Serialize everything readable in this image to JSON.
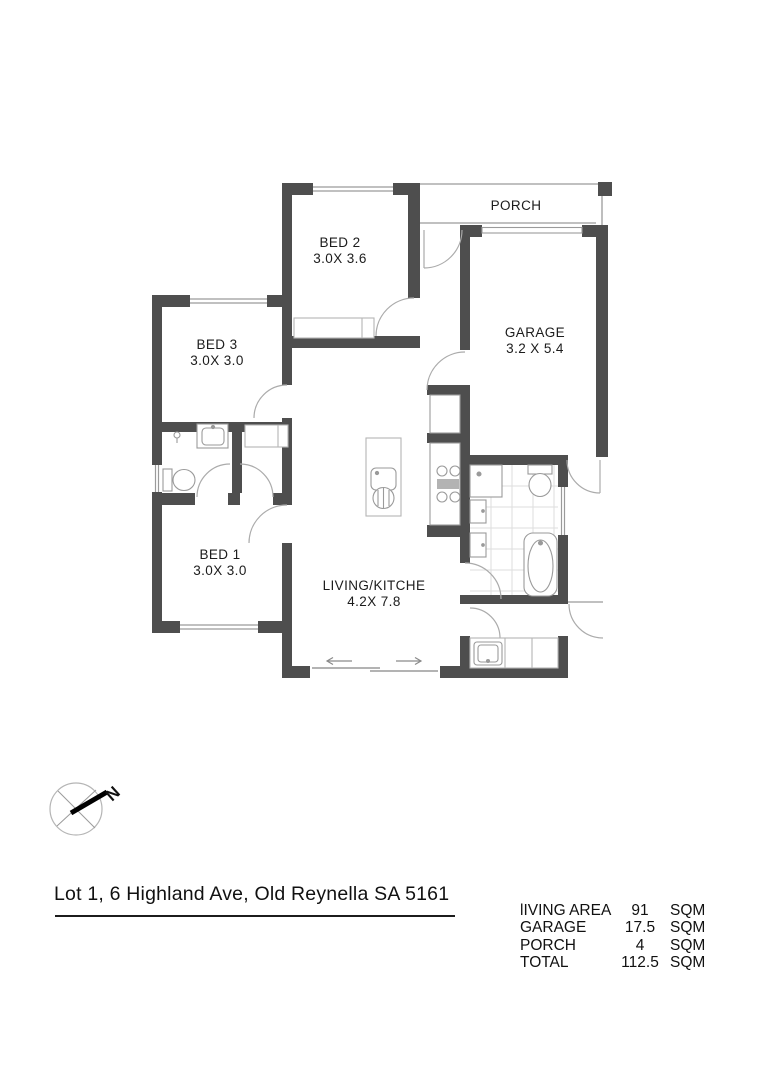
{
  "plan": {
    "rooms": [
      {
        "name": "BED 2",
        "dims": "3.0X 3.6"
      },
      {
        "name": "BED 3",
        "dims": "3.0X 3.0"
      },
      {
        "name": "BED 1",
        "dims": "3.0X 3.0"
      },
      {
        "name": "GARAGE",
        "dims": "3.2 X 5.4"
      },
      {
        "name": "LIVING/KITCHE",
        "dims": "4.2X 7.8"
      },
      {
        "name": "PORCH",
        "dims": ""
      }
    ],
    "compass_label": "N"
  },
  "footer": {
    "address": "Lot 1, 6 Highland Ave, Old Reynella SA 5161",
    "areas": {
      "rows": [
        {
          "label": "lIVING AREA",
          "value": "91",
          "unit": "SQM"
        },
        {
          "label": "GARAGE",
          "value": "17.5",
          "unit": "SQM"
        },
        {
          "label": "PORCH",
          "value": "4",
          "unit": "SQM"
        },
        {
          "label": "TOTAL",
          "value": "112.5",
          "unit": "SQM"
        }
      ]
    }
  },
  "colors": {
    "wall": "#4e4e4e",
    "thin_line": "#9a9a9a",
    "arc": "#ababab",
    "tile": "#dddddd",
    "text": "#1c1c1c"
  }
}
